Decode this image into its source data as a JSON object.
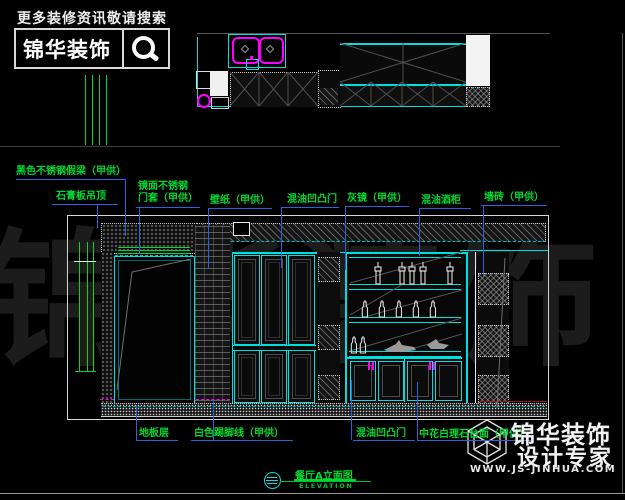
{
  "header": {
    "search_hint": "更多装修资讯敬请搜索",
    "logo_text": "锦华装饰"
  },
  "watermark": {
    "text": "锦华装饰"
  },
  "annotations": {
    "top": [
      {
        "id": "fake-beam",
        "text": "黑色不锈钢假梁（甲供）"
      },
      {
        "id": "gypsum-ceiling",
        "text": "石膏板吊顶"
      },
      {
        "id": "mirror-door-casing",
        "lines": [
          "镜面不锈钢",
          "门套（甲供）"
        ]
      },
      {
        "id": "wallpaper",
        "text": "壁纸（甲供）"
      },
      {
        "id": "paint-panel-door",
        "text": "混油凹凸门"
      },
      {
        "id": "grey-mirror",
        "text": "灰镜（甲供）"
      },
      {
        "id": "paint-wine-cabinet",
        "text": "混油酒柜"
      },
      {
        "id": "wall-tile",
        "text": "墙砖（甲供）"
      }
    ],
    "bottom": [
      {
        "id": "floor-layer",
        "text": "地板层"
      },
      {
        "id": "white-skirting",
        "text": "白色踢脚线（甲供）"
      },
      {
        "id": "paint-panel-door",
        "text": "混油凹凸门"
      },
      {
        "id": "marble-countertop",
        "text": "中花白理石台面（甲供）"
      }
    ]
  },
  "title_block": {
    "name": "餐厅A立面图",
    "subtitle": "ELEVATION"
  },
  "brand": {
    "name": "锦华装饰",
    "tagline": "设计专家",
    "website": "WWW.JS-JINHUA.COM"
  },
  "colors": {
    "cad_cyan": "#00dede",
    "cad_green": "#00d832",
    "leader_blue": "#2e62d9",
    "cad_magenta": "#ff00ff",
    "watermark_gray": "#1c1c1c"
  }
}
